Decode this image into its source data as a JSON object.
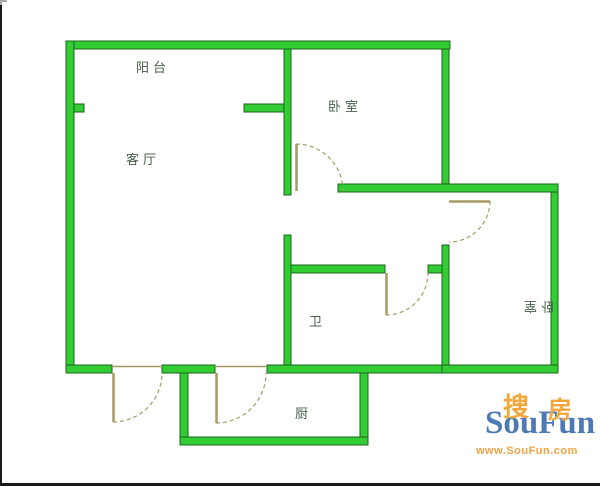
{
  "floorplan": {
    "colors": {
      "wall_fill": "#32cd32",
      "wall_stroke": "#1c641c",
      "door_color": "#a69a64",
      "label_color": "#47604c"
    },
    "rooms": {
      "balcony": {
        "label": "阳台"
      },
      "living_room": {
        "label": "客厅"
      },
      "bedroom_top": {
        "label": "卧室"
      },
      "bathroom": {
        "label": "卫"
      },
      "kitchen": {
        "label": "厨"
      },
      "bedroom_right": {
        "label": "卧室"
      }
    }
  },
  "watermark": {
    "cn_char_1": "搜",
    "cn_char_2": "房",
    "brand": "SouFun",
    "url": "www.SouFun.com",
    "colors": {
      "brand_blue": "#4d79b5",
      "brand_orange": "#f3a73a"
    }
  }
}
